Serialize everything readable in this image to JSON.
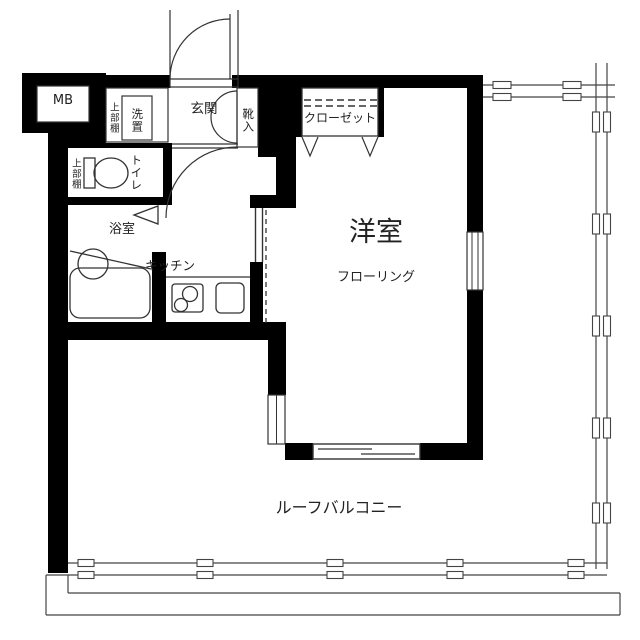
{
  "title": "apartment-floorplan",
  "labels": {
    "meter_box": "MB",
    "laundry_upper_shelf": "上部棚",
    "laundry_space": "洗置",
    "entrance": "玄関",
    "shoe_cabinet": "靴入",
    "closet": "クローゼット",
    "toilet_upper_shelf": "上部棚",
    "toilet": "トイレ",
    "bathroom": "浴室",
    "kitchen": "キッチン",
    "western_room": "洋室",
    "flooring": "フローリング",
    "roof_balcony": "ルーフバルコニー"
  },
  "colors": {
    "wall": "#000000",
    "background": "#ffffff",
    "line": "#333333",
    "text": "#222222"
  }
}
